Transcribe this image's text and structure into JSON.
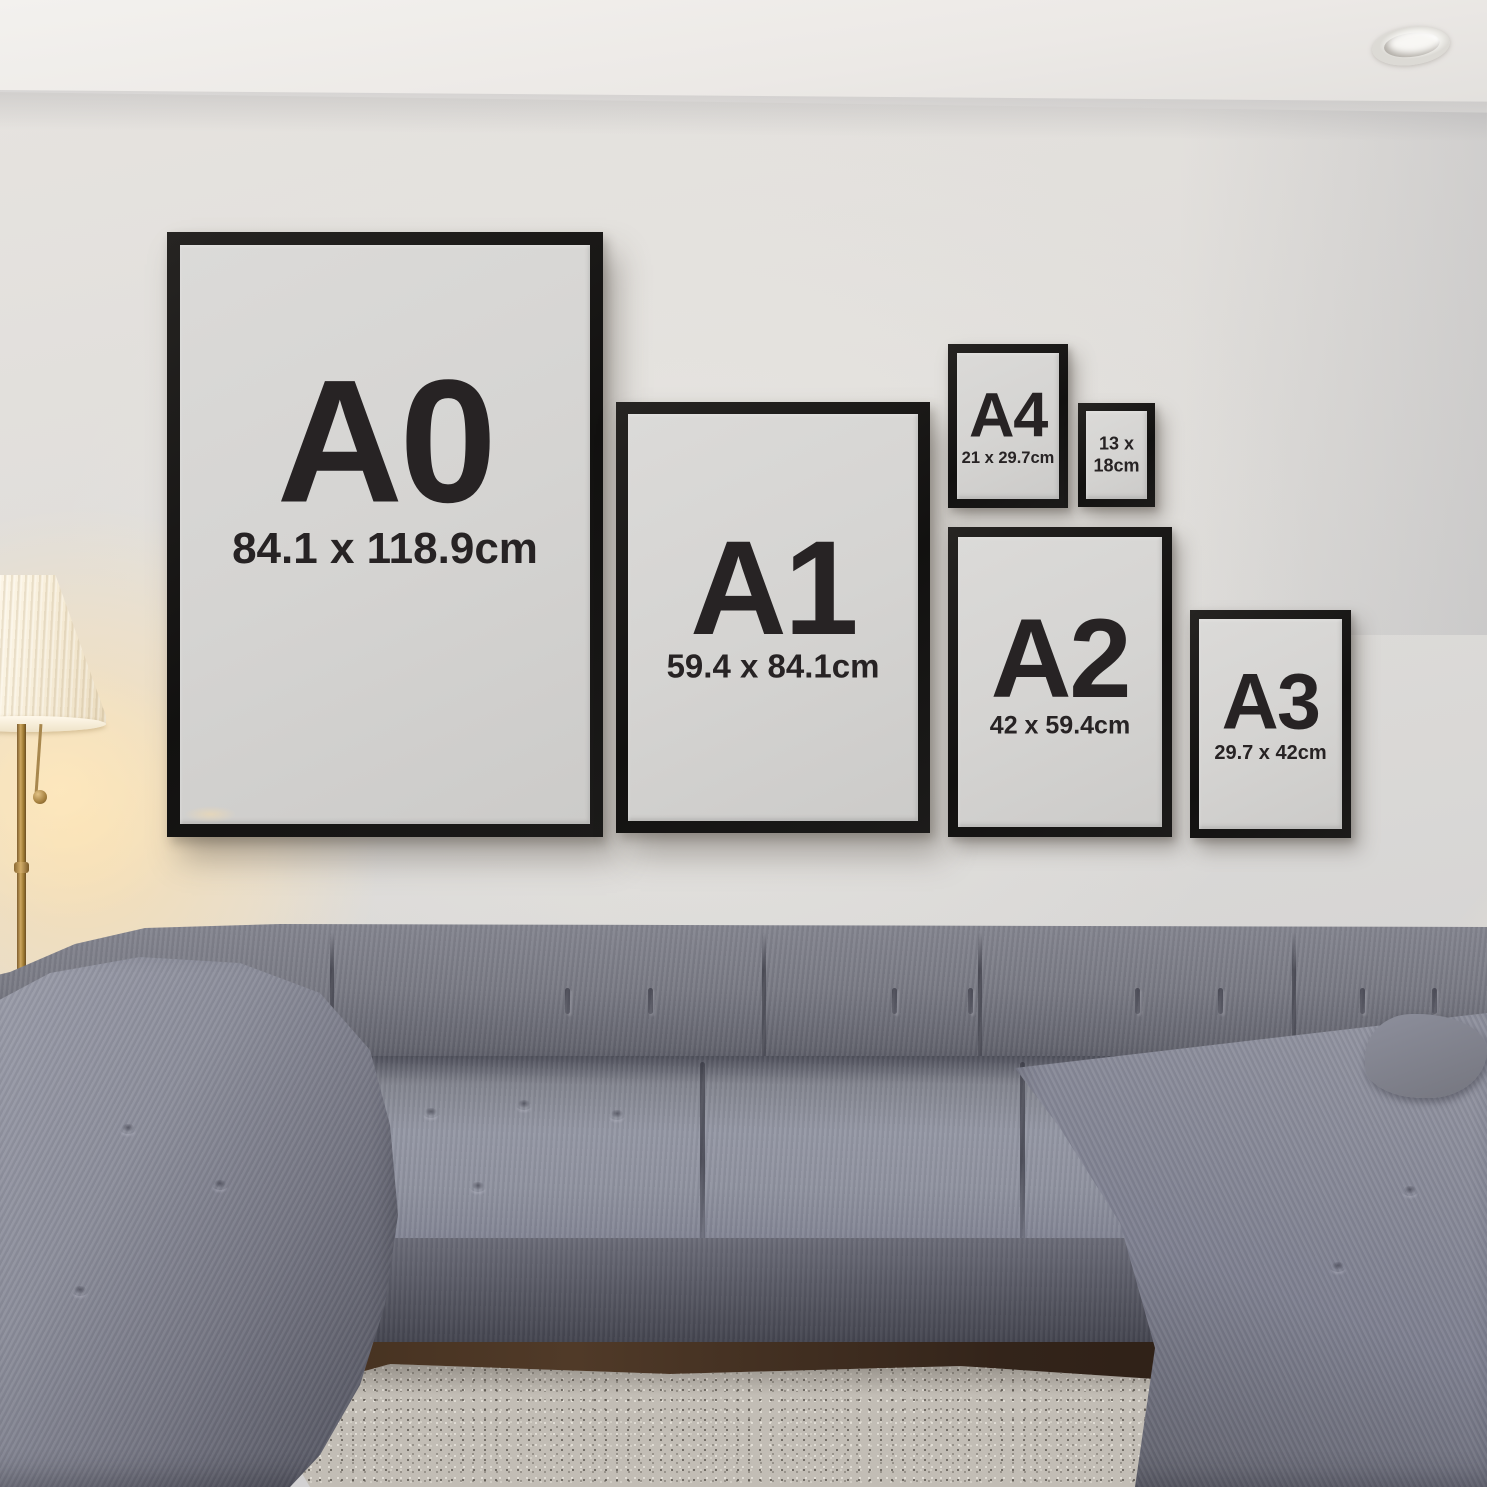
{
  "scene": {
    "kind": "living-room frame size mockup photo",
    "palette": {
      "frame_black": "#141312",
      "poster_paper": "#d5d4d2",
      "poster_text": "#272324",
      "wall": "#dedcd9",
      "ceiling": "#f0eeeb",
      "sofa_gray": "#7e808e",
      "sofa_shadow": "#4b4c57",
      "rug": "#c2bdb5",
      "wood_floor": "#3a2a1e",
      "lamp_glow": "#f7e7c8",
      "lamp_brass": "#b3894a"
    }
  },
  "posters": [
    {
      "id": "a0",
      "label": "A0",
      "size": "84.1 x 118.9cm"
    },
    {
      "id": "a1",
      "label": "A1",
      "size": "59.4 x 84.1cm"
    },
    {
      "id": "a4",
      "label": "A4",
      "size": "21 x 29.7cm"
    },
    {
      "id": "13x18",
      "label": "",
      "size": "13 x\n18cm"
    },
    {
      "id": "a2",
      "label": "A2",
      "size": "42 x 59.4cm"
    },
    {
      "id": "a3",
      "label": "A3",
      "size": "29.7 x 42cm"
    }
  ]
}
